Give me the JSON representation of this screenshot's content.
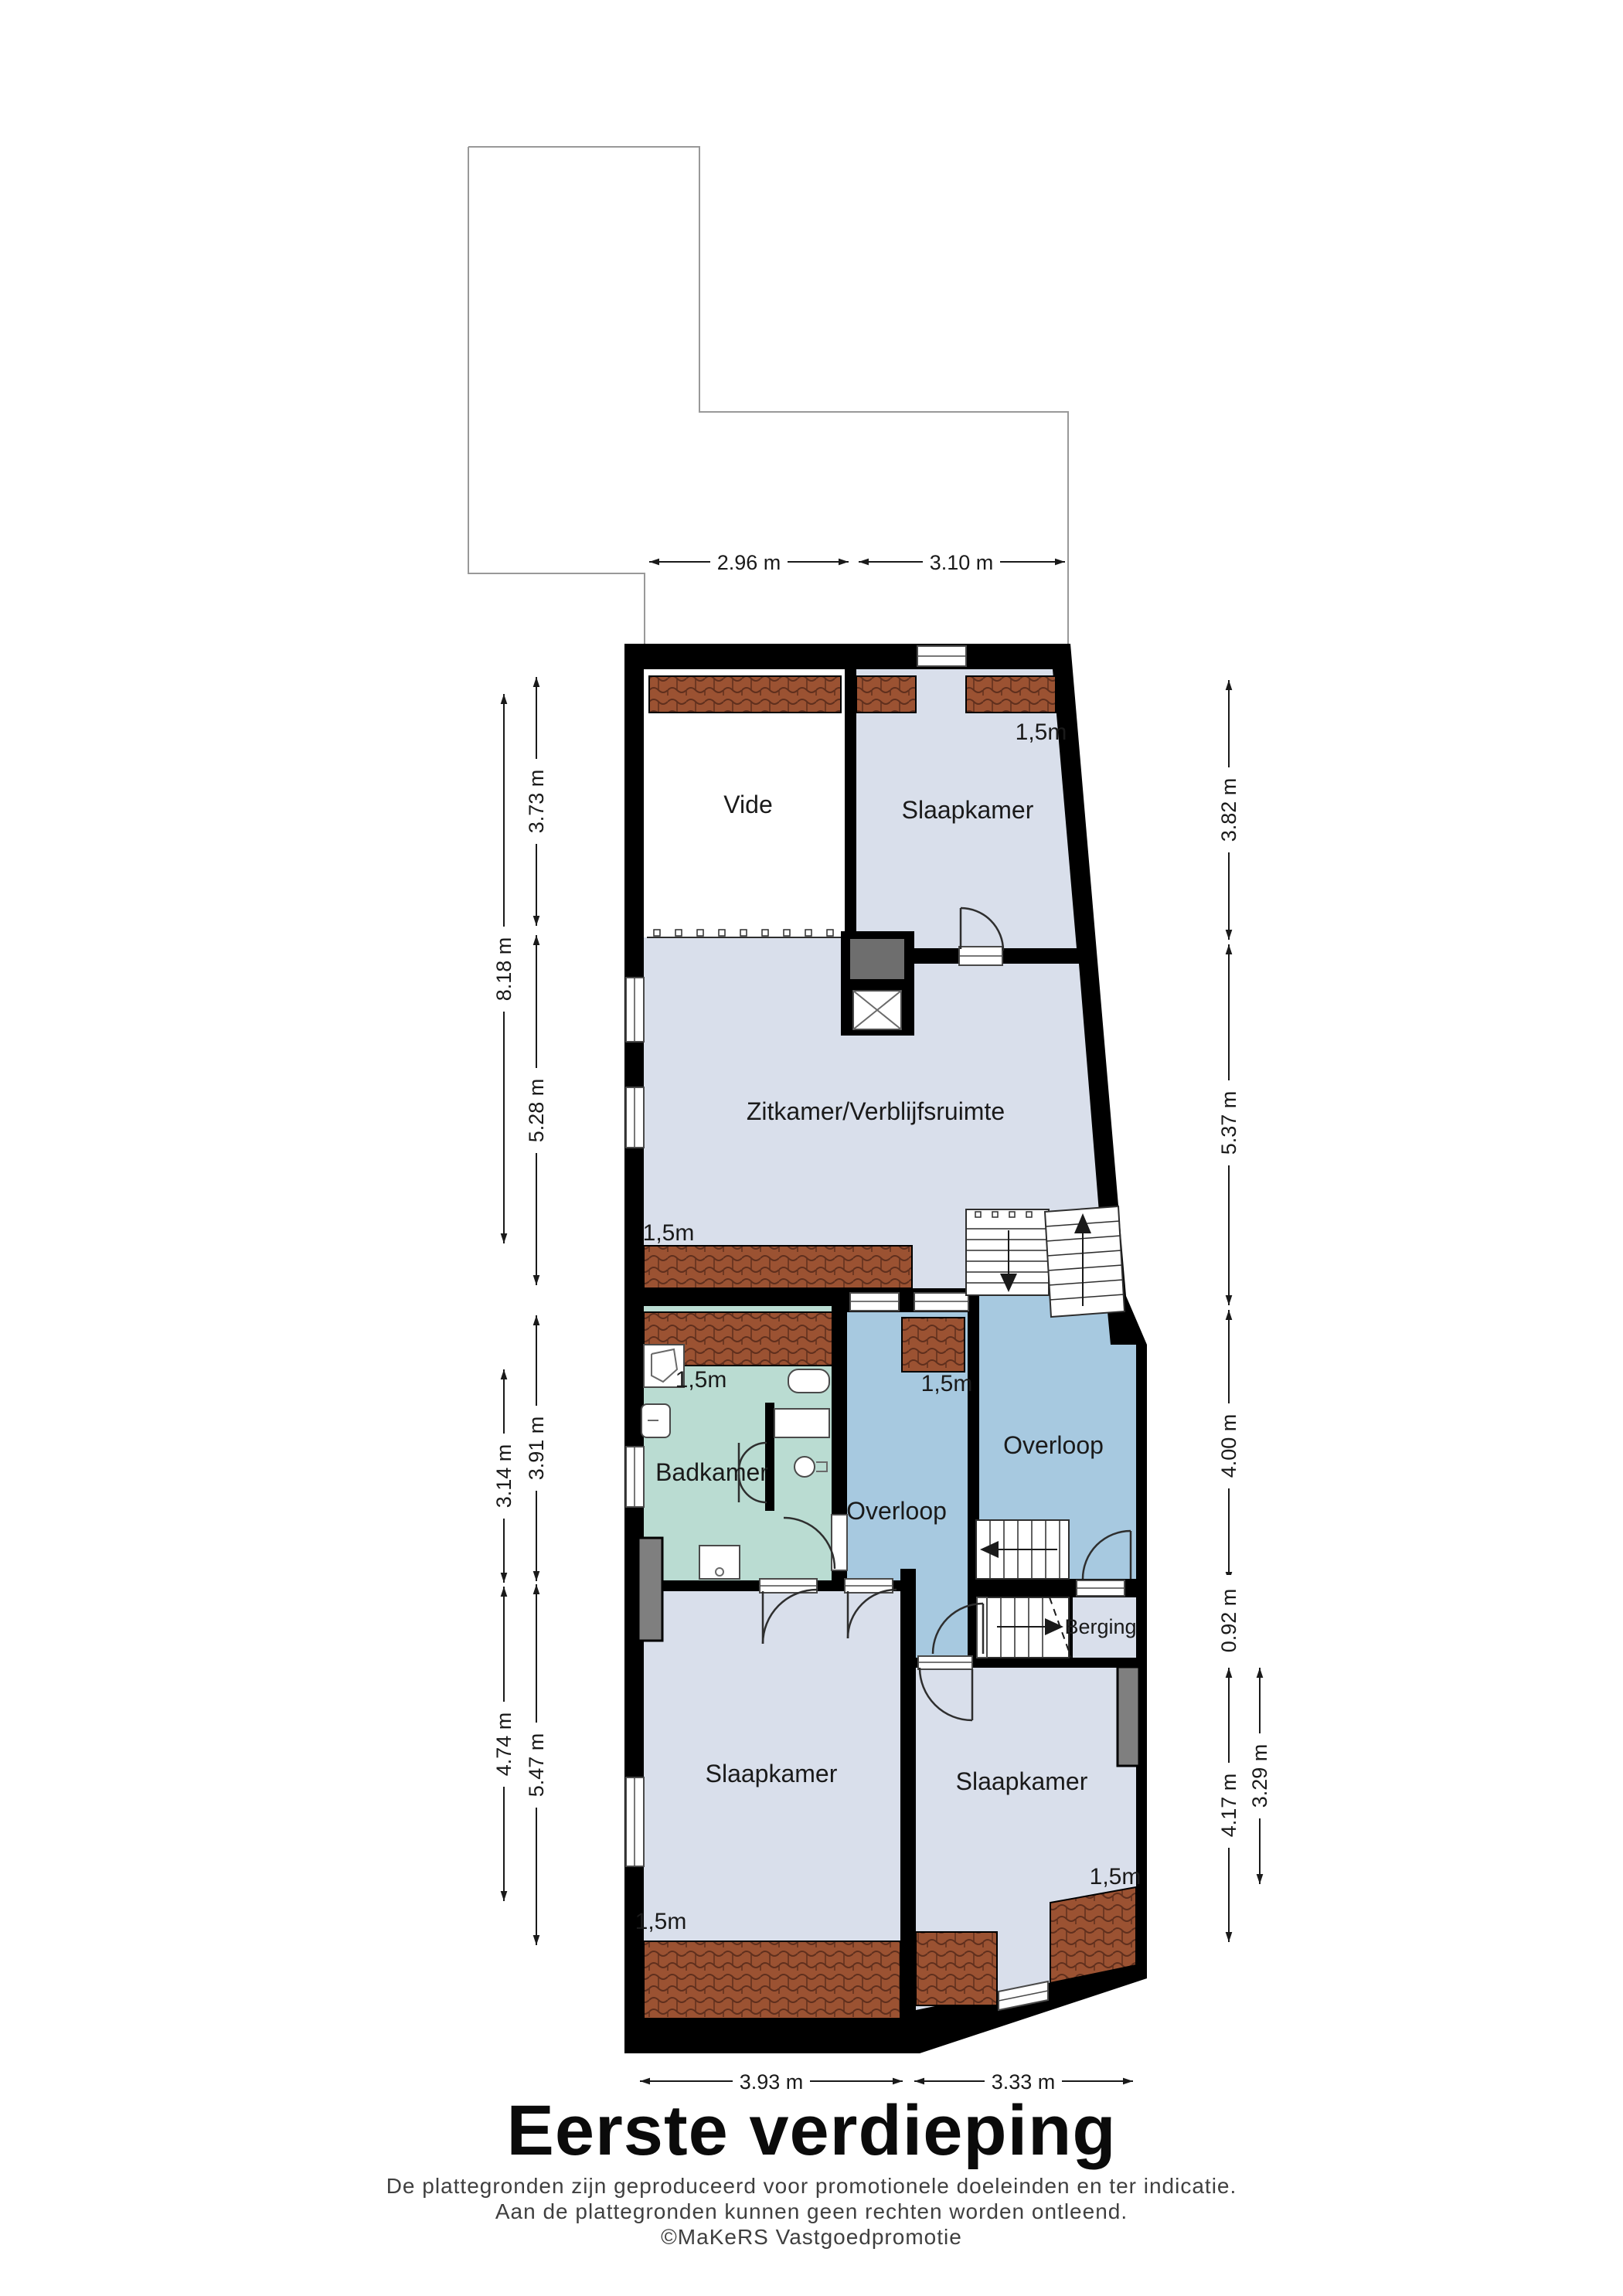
{
  "title": "Eerste verdieping",
  "footer": {
    "line1": "De plattegronden zijn geproduceerd voor promotionele doeleinden en ter indicatie.",
    "line2": "Aan de plattegronden kunnen geen rechten worden ontleend.",
    "line3": "©MaKeRS Vastgoedpromotie"
  },
  "rooms": {
    "vide": "Vide",
    "slaapkamer_top": "Slaapkamer",
    "zitkamer": "Zitkamer/Verblijfsruimte",
    "badkamer": "Badkamer",
    "overloop_mid": "Overloop",
    "overloop_right": "Overloop",
    "berging": "Berging",
    "slaapkamer_left": "Slaapkamer",
    "slaapkamer_right": "Slaapkamer"
  },
  "height_label": "1,5m",
  "dimensions": {
    "top": [
      "2.96 m",
      "3.10 m"
    ],
    "bottom": [
      "3.93 m",
      "3.33 m"
    ],
    "left_outer": [
      "8.18 m",
      "3.14 m",
      "4.74 m"
    ],
    "left_inner": [
      "3.73 m",
      "5.28 m",
      "3.91 m",
      "5.47 m"
    ],
    "right_outer": [
      "3.82 m",
      "5.37 m",
      "4.00 m",
      "0.92 m",
      "4.17 m"
    ],
    "right_inner": [
      "3.29 m"
    ]
  },
  "colors": {
    "wall": "#000000",
    "room": "#d9dfeb",
    "hall": "#a7c9e0",
    "bath": "#badcd2",
    "roof": "#9b5232",
    "roof-dark": "#5f2f1d",
    "chimney": "#7f7f7f",
    "outline": "#999999",
    "line": "#1a1a1a",
    "text": "#1a1a1a",
    "footer": "#3f3f3f"
  }
}
